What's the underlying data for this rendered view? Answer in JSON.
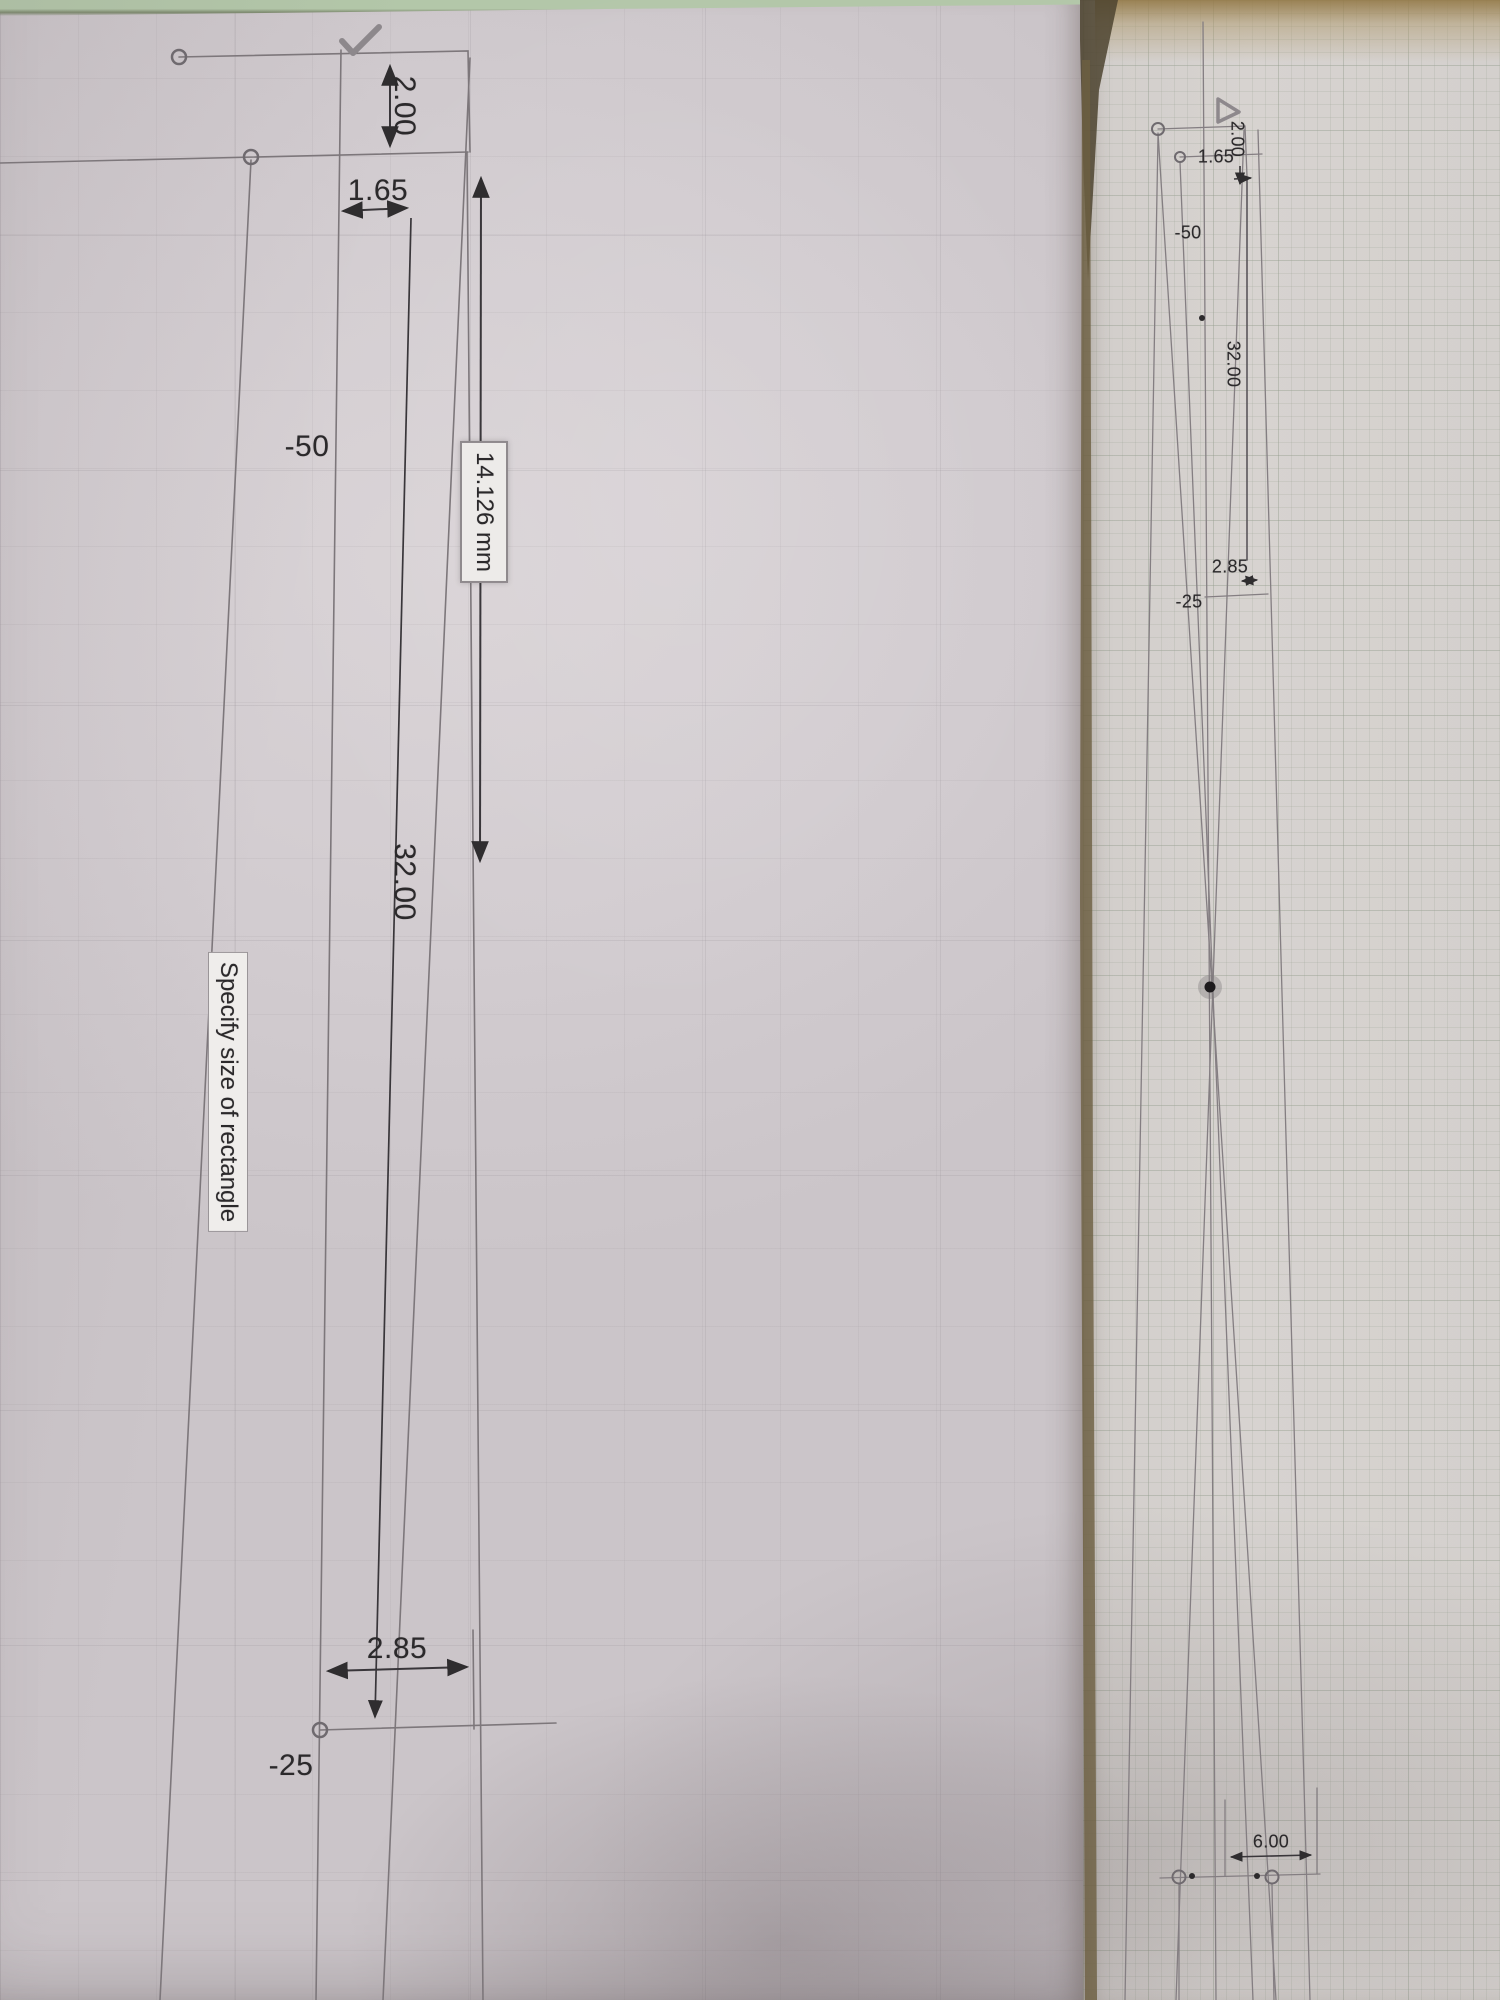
{
  "colors": {
    "paper_left": "#d2ccd0",
    "paper_right": "#d5d1ce",
    "table_green": "#b3c7a9",
    "table_brown": "#5e5238",
    "table_tan": "#b49d72",
    "ink": "#2f2d2f",
    "construction_line": "#837d81"
  },
  "left_sheet": {
    "dim_2_00": "2.00",
    "dim_1_65": "1.65",
    "coord_neg_50": "-50",
    "dim_input_value": "14.126 mm",
    "dim_32_00": "32.00",
    "tooltip": "Specify size of rectangle",
    "dim_2_85": "2.85",
    "coord_neg_25": "-25"
  },
  "right_sheet": {
    "dim_2_00": "2.00",
    "dim_1_65": "1.65",
    "coord_neg_50": "-50",
    "dim_32_00": "32.00",
    "dim_2_85": "2.85",
    "coord_neg_25": "-25",
    "dim_6_00": "6.00"
  }
}
